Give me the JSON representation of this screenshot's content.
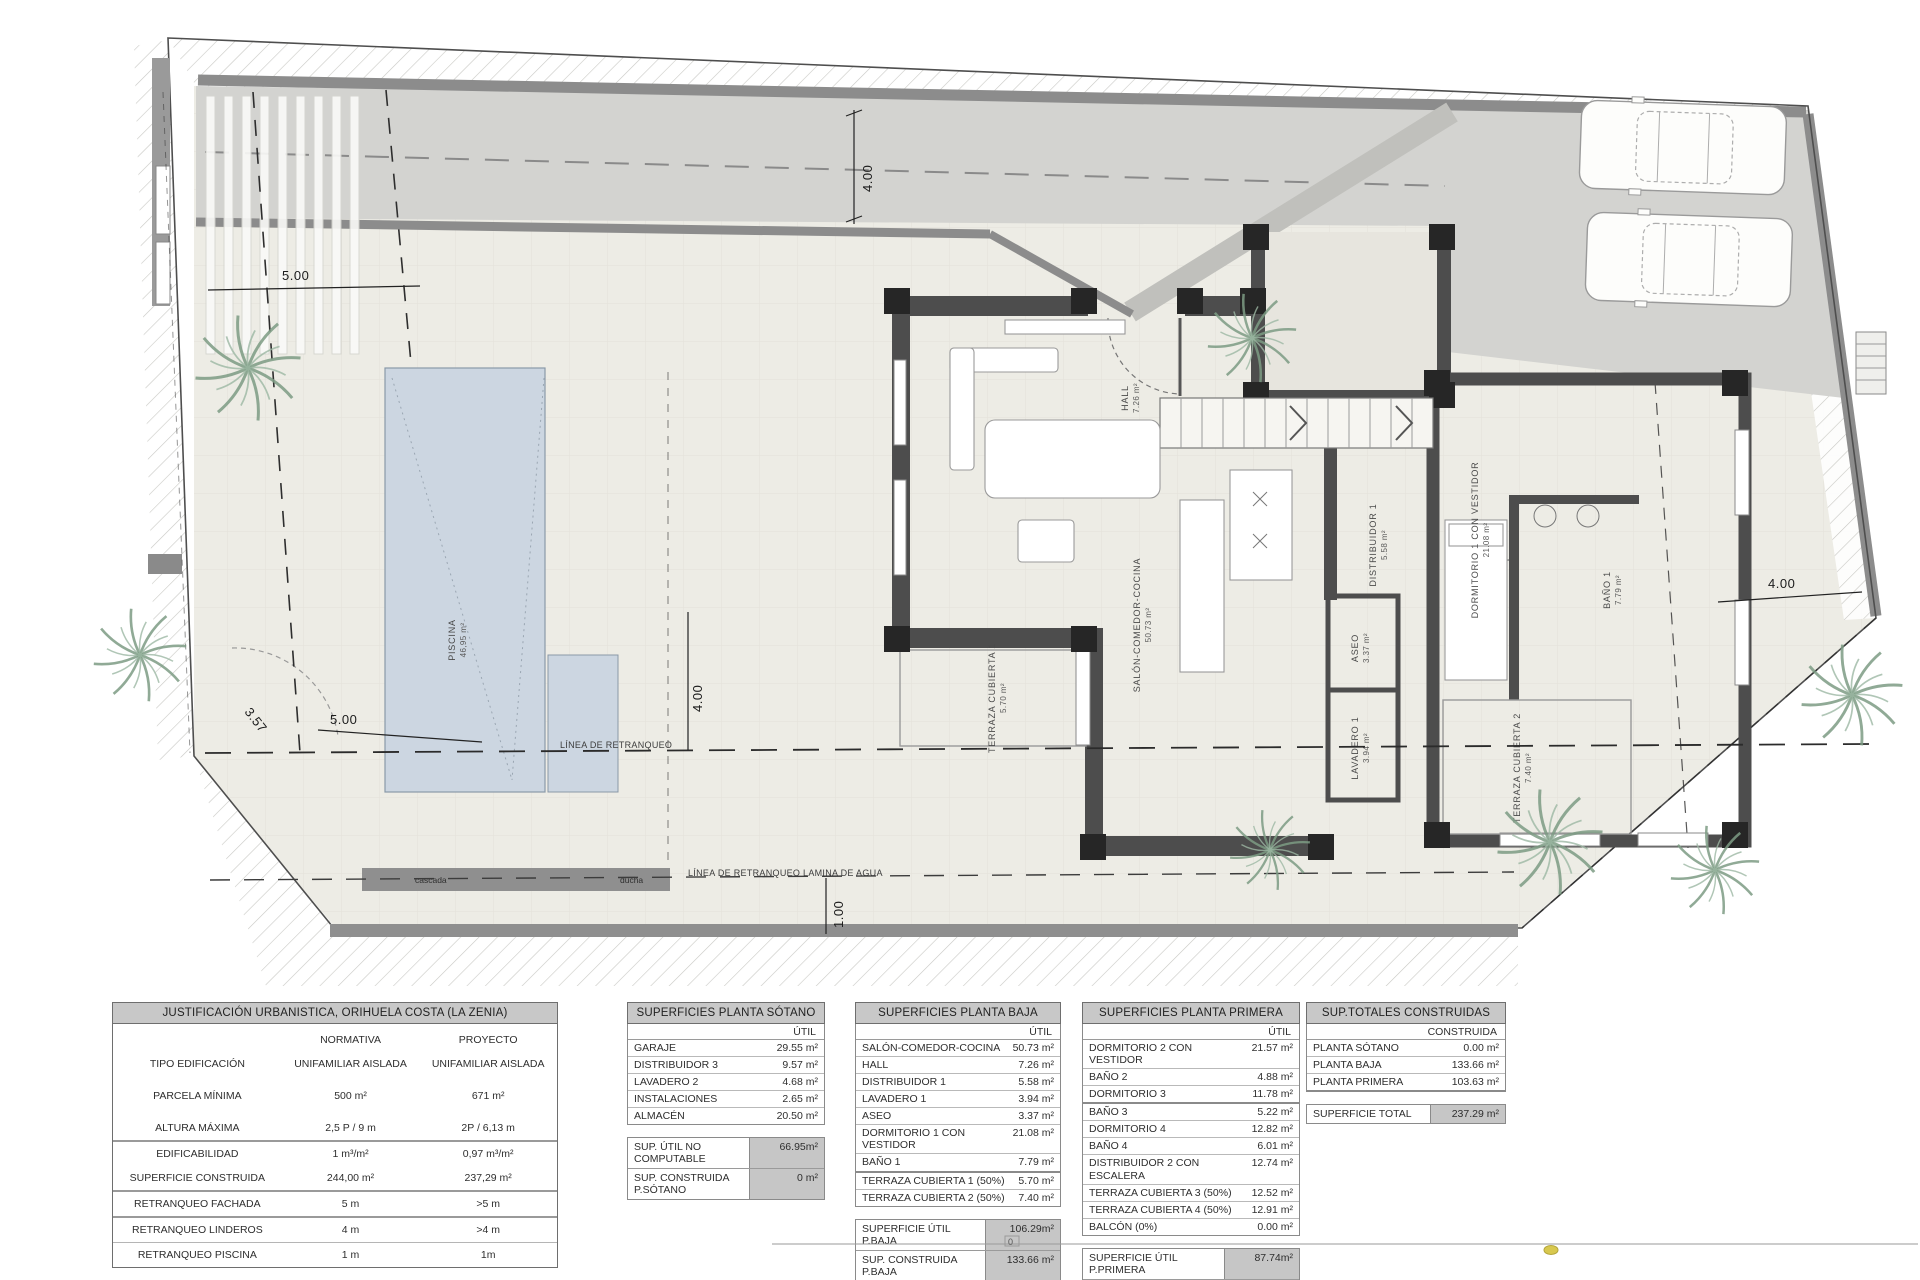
{
  "plan": {
    "rooms": [
      {
        "name": "HALL",
        "area": "7.26 m²"
      },
      {
        "name": "SALÓN-COMEDOR-COCINA",
        "area": "50.73 m²"
      },
      {
        "name": "DISTRIBUIDOR 1",
        "area": "5.58 m²"
      },
      {
        "name": "ASEO",
        "area": "3.37 m²"
      },
      {
        "name": "LAVADERO 1",
        "area": "3.94 m²"
      },
      {
        "name": "DORMITORIO 1 CON VESTIDOR",
        "area": "21.08 m²"
      },
      {
        "name": "BAÑO 1",
        "area": "7.79 m²"
      },
      {
        "name": "TERRAZA CUBIERTA 1",
        "area": "5.70 m²"
      },
      {
        "name": "TERRAZA CUBIERTA 2",
        "area": "7.40 m²"
      }
    ],
    "pool": {
      "label": "PISCINA",
      "area": "46,95 m²",
      "cascada": "cascada",
      "ducha": "ducha"
    },
    "lines": {
      "retranqueo": "LÍNEA DE RETRANQUEO",
      "retranqueo_agua": "LÍNEA DE RETRANQUEO LAMINA DE AGUA"
    },
    "dims": {
      "top": "4.00",
      "left_top": "5.00",
      "left_bottom": "5.00",
      "diag": "3.57",
      "mid": "4.00",
      "water": "1.00",
      "right": "4.00"
    },
    "scale_zero": "0"
  },
  "tables": {
    "urbanistica": {
      "title": "JUSTIFICACIÓN URBANISTICA, ORIHUELA COSTA (LA ZENIA)",
      "col1": "NORMATIVA",
      "col2": "PROYECTO",
      "rows": [
        {
          "label": "TIPO EDIFICACIÓN",
          "normativa": "UNIFAMILIAR AISLADA",
          "proyecto": "UNIFAMILIAR AISLADA"
        },
        {
          "label": "PARCELA MÍNIMA",
          "normativa": "500 m²",
          "proyecto": "671 m²"
        },
        {
          "label": "ALTURA MÁXIMA",
          "normativa": "2,5 P / 9 m",
          "proyecto": "2P / 6,13 m"
        },
        {
          "label": "EDIFICABILIDAD",
          "normativa": "1 m³/m²",
          "proyecto": "0,97 m³/m²"
        },
        {
          "label": "SUPERFICIE CONSTRUIDA",
          "normativa": "244,00 m²",
          "proyecto": "237,29 m²"
        },
        {
          "label": "RETRANQUEO FACHADA",
          "normativa": "5 m",
          "proyecto": ">5 m"
        },
        {
          "label": "RETRANQUEO LINDEROS",
          "normativa": "4 m",
          "proyecto": ">4 m"
        },
        {
          "label": "RETRANQUEO PISCINA",
          "normativa": "1 m",
          "proyecto": "1m"
        }
      ]
    },
    "sotano": {
      "title": "SUPERFICIES PLANTA SÓTANO",
      "col": "ÚTIL",
      "rows": [
        {
          "label": "GARAJE",
          "value": "29.55 m²"
        },
        {
          "label": "DISTRIBUIDOR 3",
          "value": "9.57 m²"
        },
        {
          "label": "LAVADERO 2",
          "value": "4.68 m²"
        },
        {
          "label": "INSTALACIONES",
          "value": "2.65 m²"
        },
        {
          "label": "ALMACÉN",
          "value": "20.50 m²"
        }
      ],
      "summary": [
        {
          "label": "SUP. ÚTIL NO COMPUTABLE",
          "value": "66.95m²"
        },
        {
          "label": "SUP. CONSTRUIDA P.SÓTANO",
          "value": "0 m²"
        }
      ]
    },
    "baja": {
      "title": "SUPERFICIES PLANTA BAJA",
      "col": "ÚTIL",
      "rows": [
        {
          "label": "SALÓN-COMEDOR-COCINA",
          "value": "50.73 m²"
        },
        {
          "label": "HALL",
          "value": "7.26 m²"
        },
        {
          "label": "DISTRIBUIDOR 1",
          "value": "5.58 m²"
        },
        {
          "label": "LAVADERO 1",
          "value": "3.94 m²"
        },
        {
          "label": "ASEO",
          "value": "3.37 m²"
        },
        {
          "label": "DORMITORIO 1 CON VESTIDOR",
          "value": "21.08 m²"
        },
        {
          "label": "BAÑO 1",
          "value": "7.79 m²"
        },
        {
          "label": "TERRAZA CUBIERTA 1 (50%)",
          "value": "5.70 m²"
        },
        {
          "label": "TERRAZA CUBIERTA 2 (50%)",
          "value": "7.40 m²"
        }
      ],
      "summary": [
        {
          "label": "SUPERFICIE ÚTIL P.BAJA",
          "value": "106.29m²"
        },
        {
          "label": "SUP. CONSTRUIDA P.BAJA",
          "value": "133.66 m²"
        }
      ]
    },
    "primera": {
      "title": "SUPERFICIES PLANTA PRIMERA",
      "col": "ÚTIL",
      "rows": [
        {
          "label": "DORMITORIO 2 CON VESTIDOR",
          "value": "21.57 m²"
        },
        {
          "label": "BAÑO 2",
          "value": "4.88 m²"
        },
        {
          "label": "DORMITORIO 3",
          "value": "11.78 m²"
        },
        {
          "label": "BAÑO 3",
          "value": "5.22 m²"
        },
        {
          "label": "DORMITORIO 4",
          "value": "12.82 m²"
        },
        {
          "label": "BAÑO 4",
          "value": "6.01 m²"
        },
        {
          "label": "DISTRIBUIDOR 2 CON ESCALERA",
          "value": "12.74 m²"
        },
        {
          "label": "TERRAZA CUBIERTA 3 (50%)",
          "value": "12.52 m²"
        },
        {
          "label": "TERRAZA CUBIERTA 4 (50%)",
          "value": "12.91 m²"
        },
        {
          "label": "BALCÓN (0%)",
          "value": "0.00 m²"
        }
      ],
      "summary": [
        {
          "label": "SUPERFICIE ÚTIL P.PRIMERA",
          "value": "87.74m²"
        },
        {
          "label": "SUP. CONSTRUIDA P.PRIMERA",
          "value": "103.63 m²"
        }
      ]
    },
    "totales": {
      "title": "SUP.TOTALES CONSTRUIDAS",
      "col": "CONSTRUIDA",
      "rows": [
        {
          "label": "PLANTA SÓTANO",
          "value": "0.00 m²"
        },
        {
          "label": "PLANTA BAJA",
          "value": "133.66 m²"
        },
        {
          "label": "PLANTA PRIMERA",
          "value": "103.63 m²"
        }
      ],
      "summary": [
        {
          "label": "SUPERFICIE TOTAL",
          "value": "237.29 m²"
        }
      ]
    }
  }
}
